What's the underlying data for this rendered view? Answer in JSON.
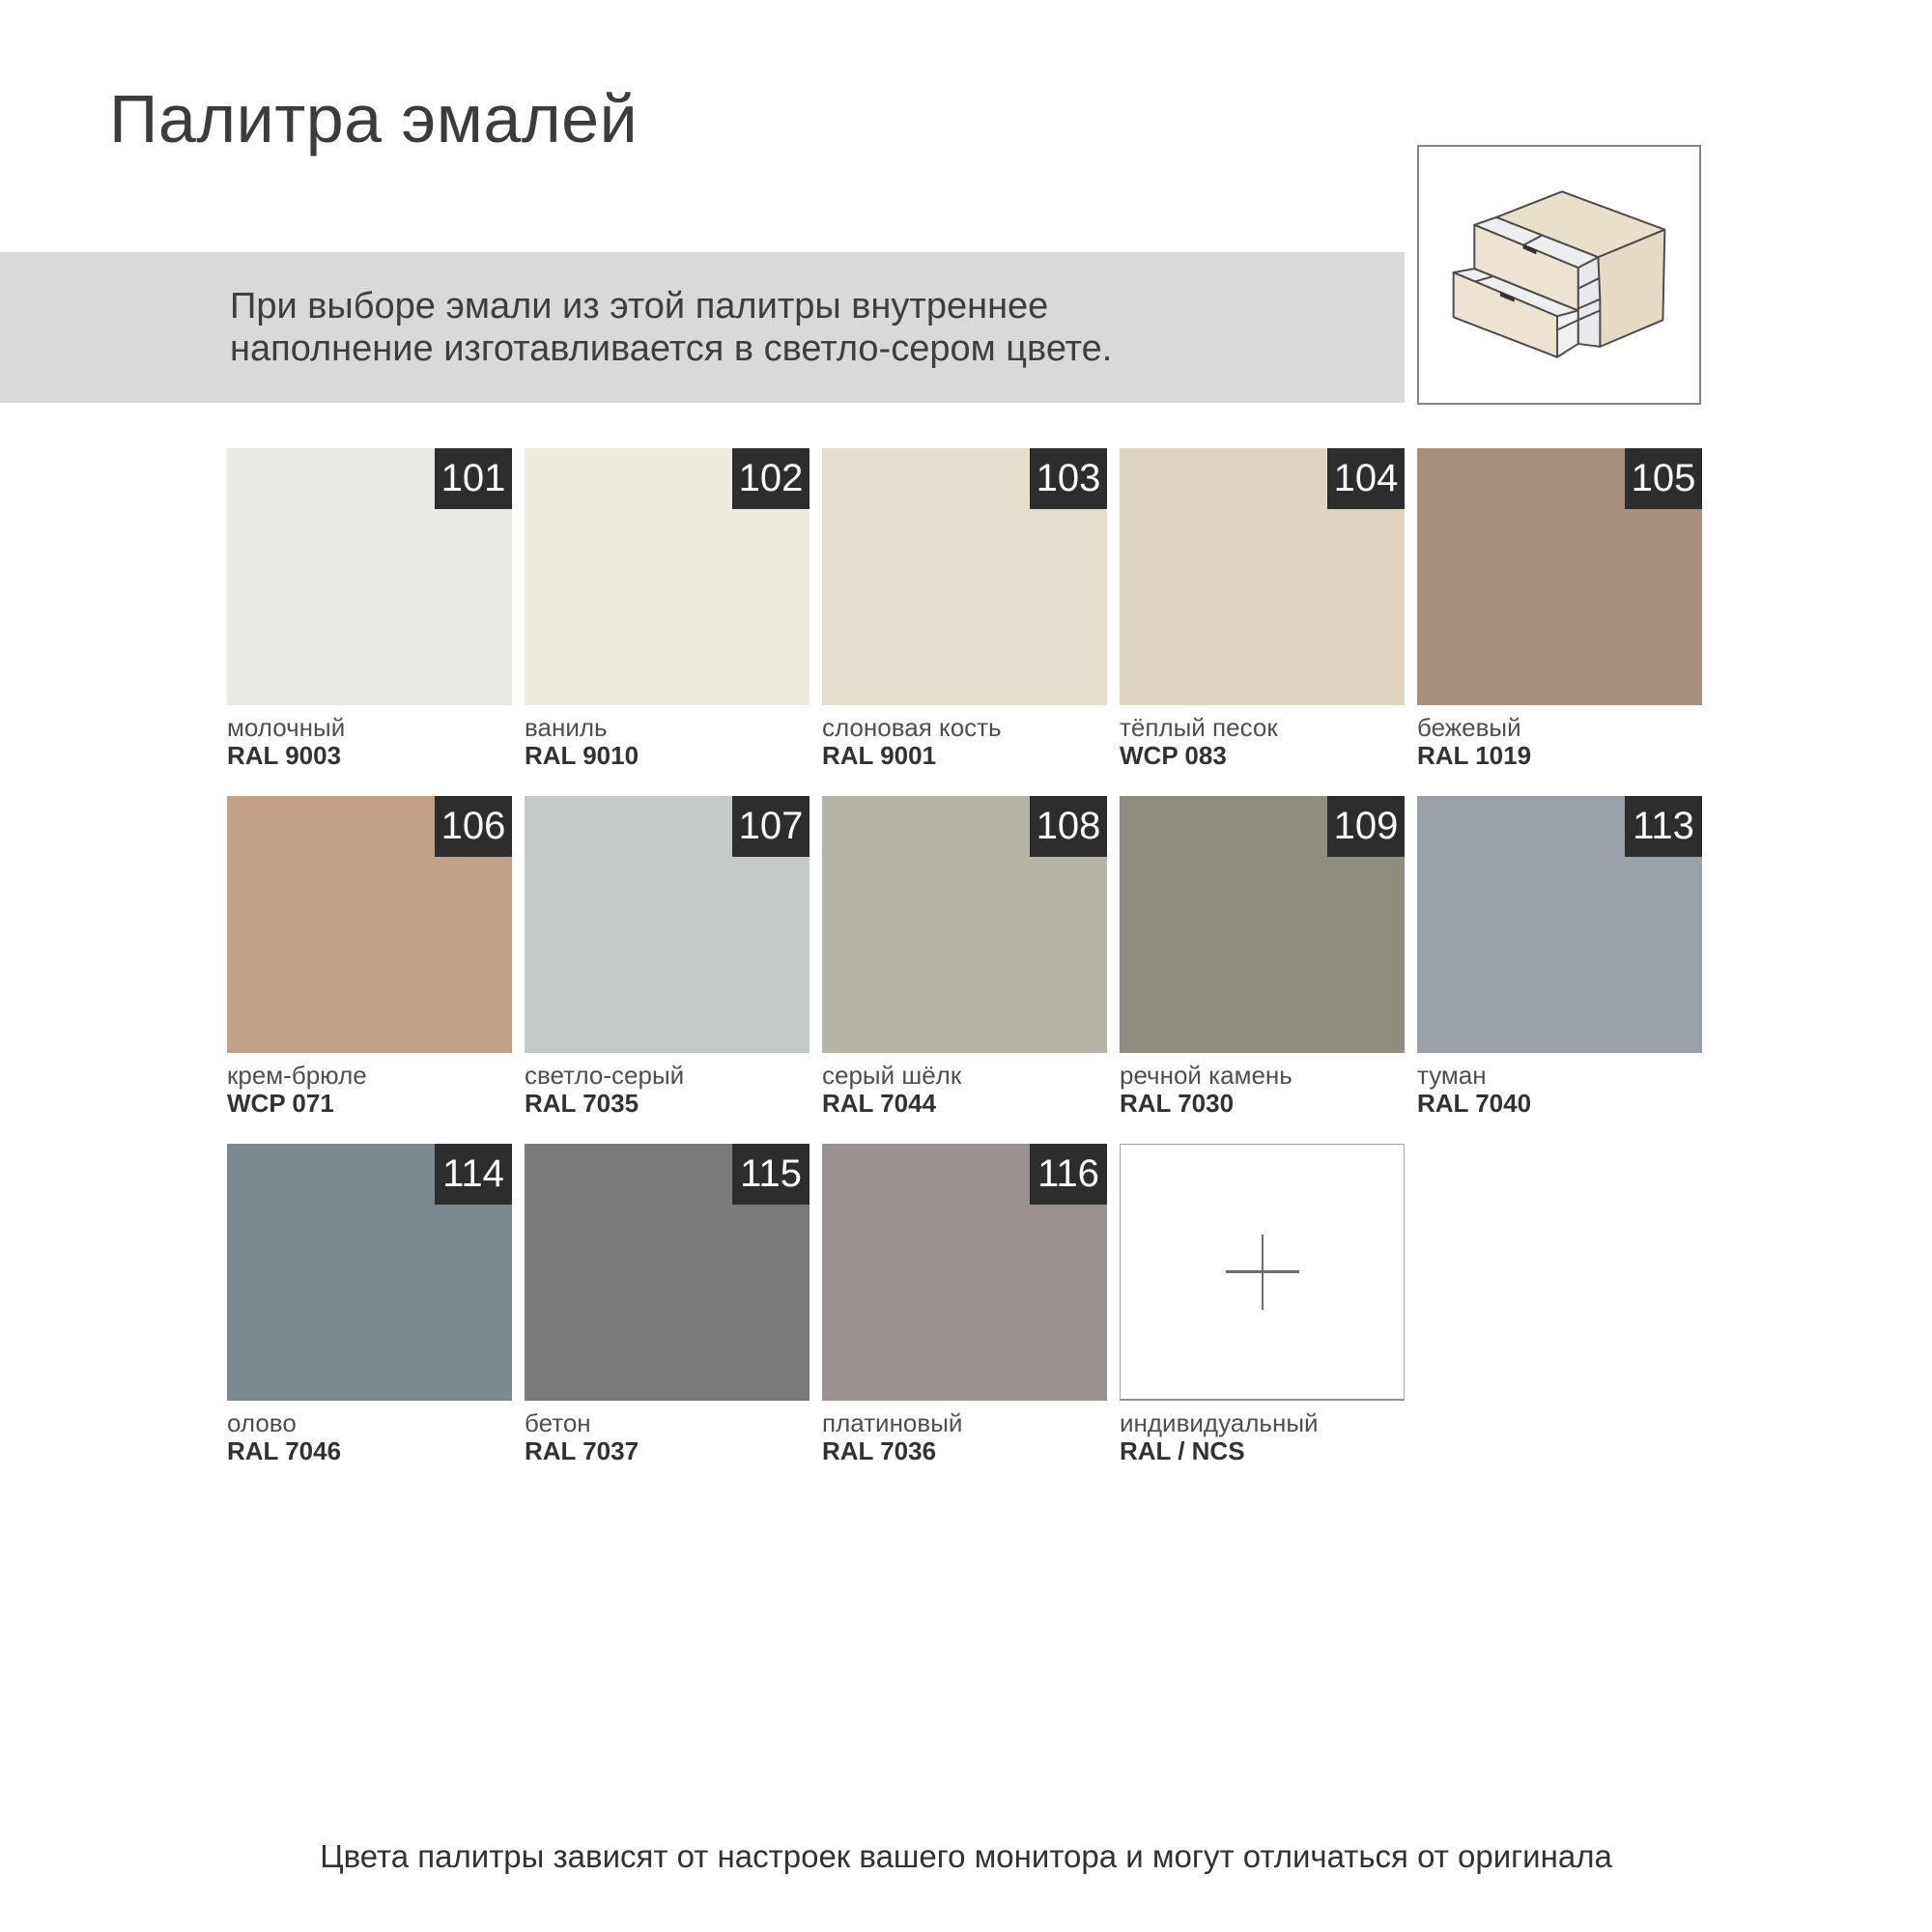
{
  "header": {
    "title": "Палитра эмалей"
  },
  "note": {
    "line1": "При выборе эмали из этой палитры внутреннее",
    "line2": "наполнение изготавливается в светло-сером цвете.",
    "bar_bg": "#d9d9d9"
  },
  "illustration": {
    "name": "two-drawer-cabinet",
    "body_color": "#e9e0ca",
    "side_color": "#e5dbc3",
    "drawer_front_color": "#ece4d0",
    "inner_color": "#eeeeef",
    "outline_color": "#4b4b4b"
  },
  "palette": {
    "badge_bg": "#2d2d2d",
    "badge_text_color": "#fbfbfb",
    "swatches": [
      {
        "number": "101",
        "name": "молочный",
        "code": "RAL 9003",
        "hex": "#e9eae4",
        "custom": false
      },
      {
        "number": "102",
        "name": "ваниль",
        "code": "RAL 9010",
        "hex": "#eeece0",
        "custom": false
      },
      {
        "number": "103",
        "name": "слоновая кость",
        "code": "RAL 9001",
        "hex": "#e5decd",
        "custom": false
      },
      {
        "number": "104",
        "name": "тёплый песок",
        "code": "WCP 083",
        "hex": "#ded5c0",
        "custom": false
      },
      {
        "number": "105",
        "name": "бежевый",
        "code": "RAL 1019",
        "hex": "#a9907e",
        "custom": false
      },
      {
        "number": "106",
        "name": "крем-брюле",
        "code": "WCP 071",
        "hex": "#c2a188",
        "custom": false
      },
      {
        "number": "107",
        "name": "светло-серый",
        "code": "RAL 7035",
        "hex": "#c6cac7",
        "custom": false
      },
      {
        "number": "108",
        "name": "серый шёлк",
        "code": "RAL 7044",
        "hex": "#b6b4a6",
        "custom": false
      },
      {
        "number": "109",
        "name": "речной камень",
        "code": "RAL 7030",
        "hex": "#8f8d80",
        "custom": false
      },
      {
        "number": "113",
        "name": "туман",
        "code": "RAL 7040",
        "hex": "#99a0a6",
        "custom": false
      },
      {
        "number": "114",
        "name": "олово",
        "code": "RAL 7046",
        "hex": "#7e888f",
        "custom": false
      },
      {
        "number": "115",
        "name": "бетон",
        "code": "RAL 7037",
        "hex": "#7b7b7b",
        "custom": false
      },
      {
        "number": "116",
        "name": "платиновый",
        "code": "RAL 7036",
        "hex": "#989190",
        "custom": false
      },
      {
        "number": "",
        "name": "индивидуальный",
        "code": "RAL / NCS",
        "hex": "#ffffff",
        "custom": true
      }
    ]
  },
  "footer": {
    "disclaimer": "Цвета палитры зависят от настроек вашего монитора и могут отличаться от оригинала"
  }
}
